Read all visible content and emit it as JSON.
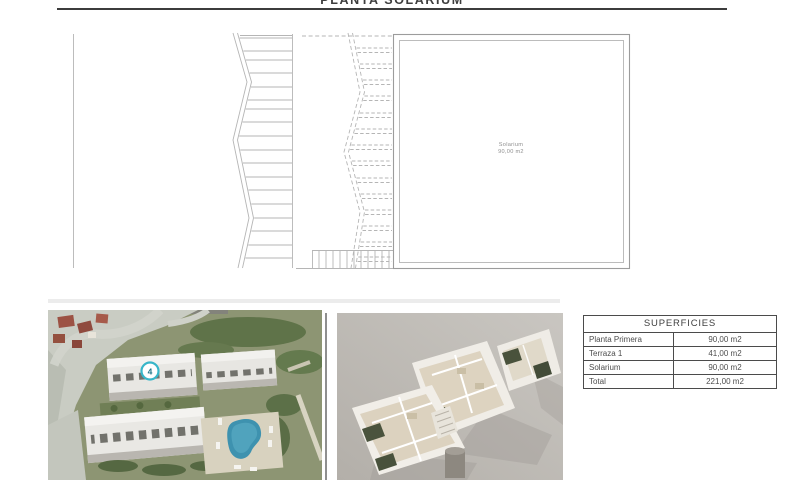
{
  "page": {
    "title": "PLANTA SOLARIUM"
  },
  "plan": {
    "room_label": "Solarium",
    "room_area": "90,00 m2"
  },
  "aerial_image": {
    "marker_label": "4"
  },
  "superficies_table": {
    "header": "SUPERFICIES",
    "rows": [
      {
        "label": "Planta Primera",
        "value": "90,00 m2"
      },
      {
        "label": "Terraza 1",
        "value": "41,00 m2"
      },
      {
        "label": "Solarium",
        "value": "90,00 m2"
      },
      {
        "label": "Total",
        "value": "221,00 m2"
      }
    ]
  },
  "colors": {
    "title_rule": "#3c3c3c",
    "plan_line": "#b5b5b5",
    "room_border": "#9c9c9c",
    "table_border": "#4b4b4b",
    "pool": "#3e92af",
    "marker_ring": "#38b6c9"
  }
}
